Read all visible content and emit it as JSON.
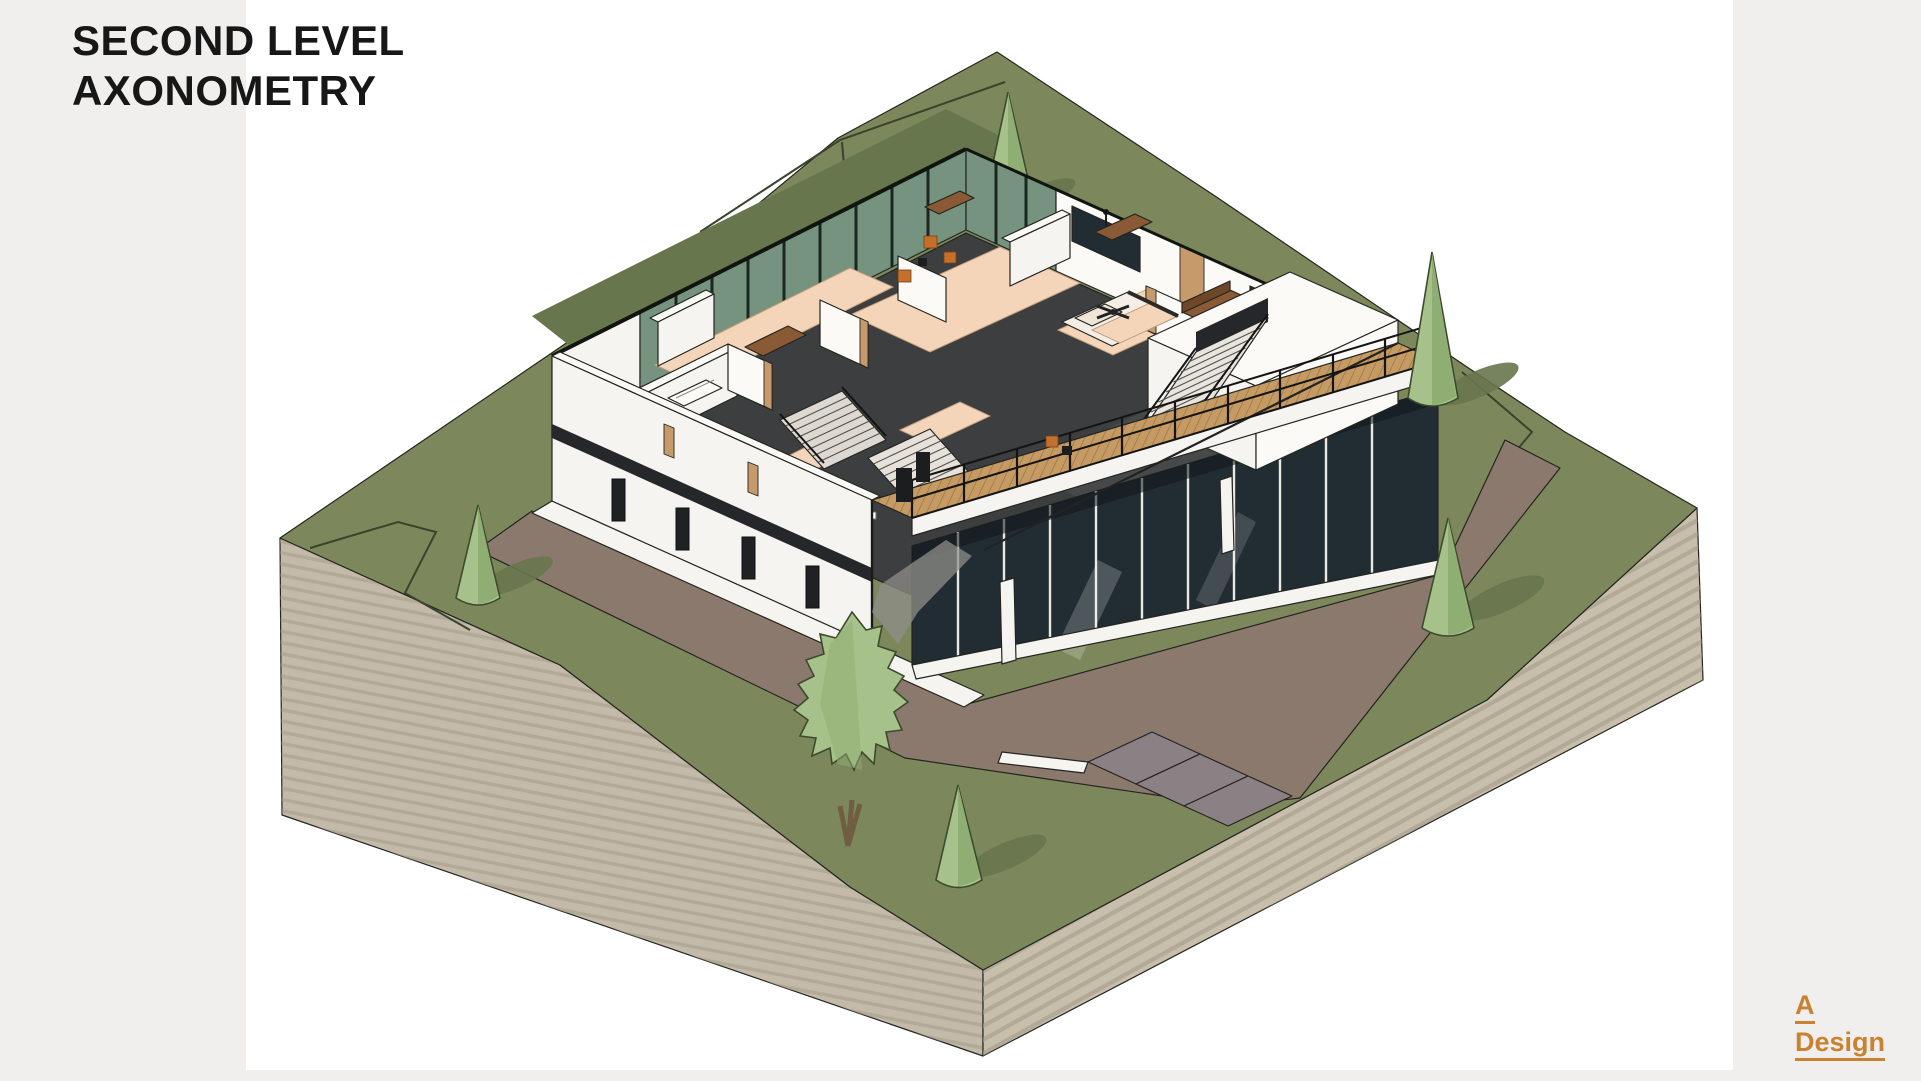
{
  "title": {
    "line1": "SECOND LEVEL",
    "line2": "AXONOMETRY"
  },
  "logo": {
    "line1": "A",
    "line2": "Design"
  },
  "illustration": {
    "alt": "Axonometric cutaway drawing of the second level of a modern two-storey house with dark floors, peach room floors, glazed walls, two staircases, furniture and a long wooden deck with railing, set on a sloped green site with conical trees, a leafy tree and a mauve driveway with grey pavers."
  },
  "colors": {
    "page-bg": "#f0efed",
    "canvas": "#ffffff",
    "title": "#171717",
    "logo": "#c9822f",
    "grass": "#7c885c",
    "grass-shadow": "#68764e",
    "contour": "#3a432c",
    "earth": "#c3baa9",
    "earth2": "#c8beac",
    "strata": "#a49a88",
    "road": "#8c796e",
    "paver": "#8b8084",
    "wall": "#f5f4f0",
    "slab": "#26272a",
    "floor": "#3c3e40",
    "peach": "#f4d5ba",
    "wood": "#c69a63",
    "furn": "#8a5a36",
    "chair": "#c4702c",
    "glass-green": "#75937e",
    "mullion": "#1a2620",
    "glass-dark": "#222d33",
    "tree": "#a6c189",
    "tree-dark": "#8fae74",
    "trunk": "#6f5e42"
  }
}
